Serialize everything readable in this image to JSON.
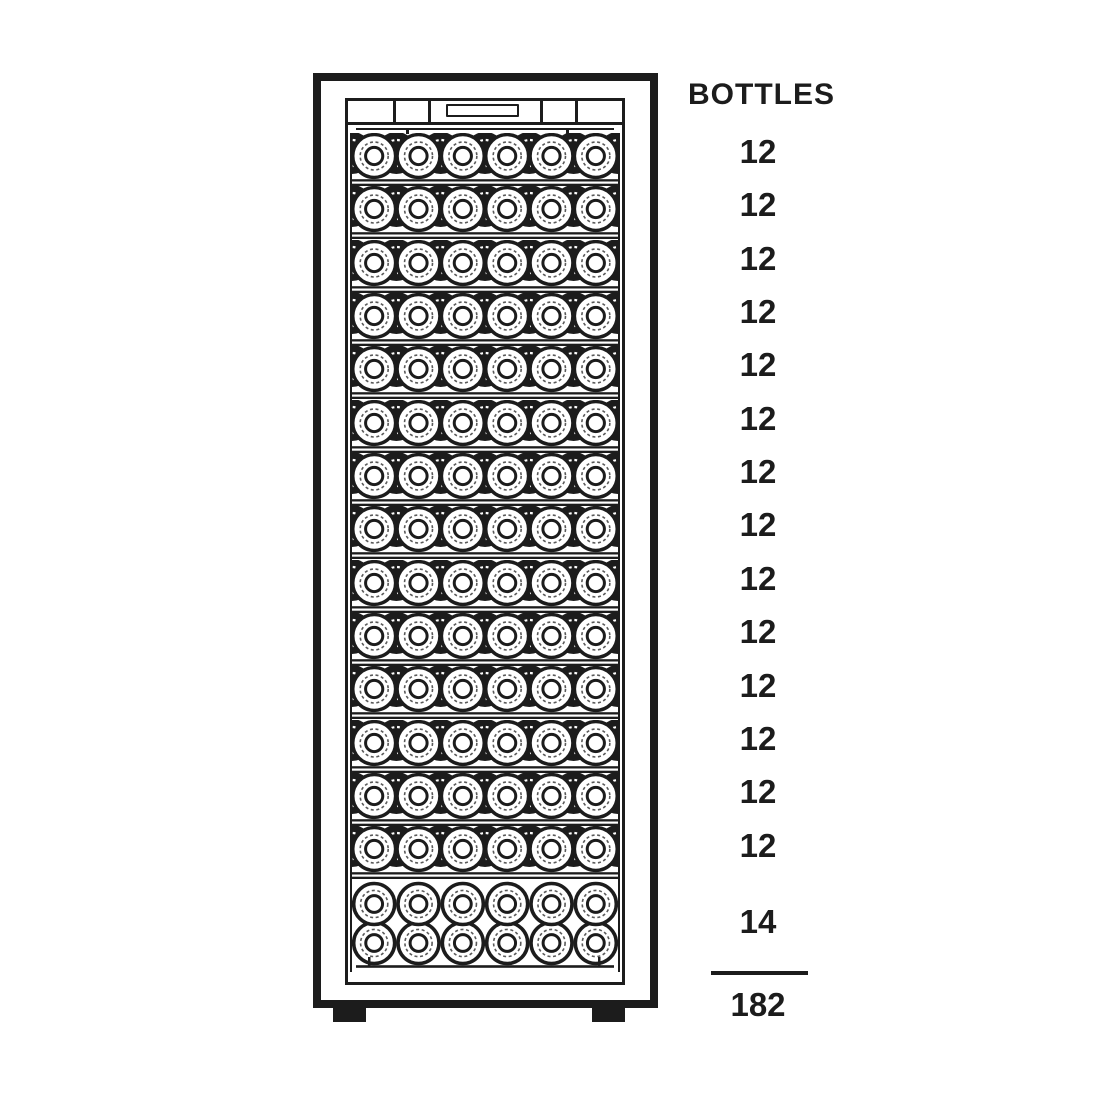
{
  "colors": {
    "ink": "#1c1c1c",
    "paper": "#ffffff"
  },
  "counts": {
    "header": "BOTTLES",
    "per_shelf": [
      12,
      12,
      12,
      12,
      12,
      12,
      12,
      12,
      12,
      12,
      12,
      12,
      12,
      12
    ],
    "bottom": 14,
    "total": 182
  },
  "cabinet": {
    "shelf_rows": 14,
    "bottles_visible_per_row": 6,
    "bottom_rows": 2,
    "bottom_bottles_visible_per_row": 6
  }
}
